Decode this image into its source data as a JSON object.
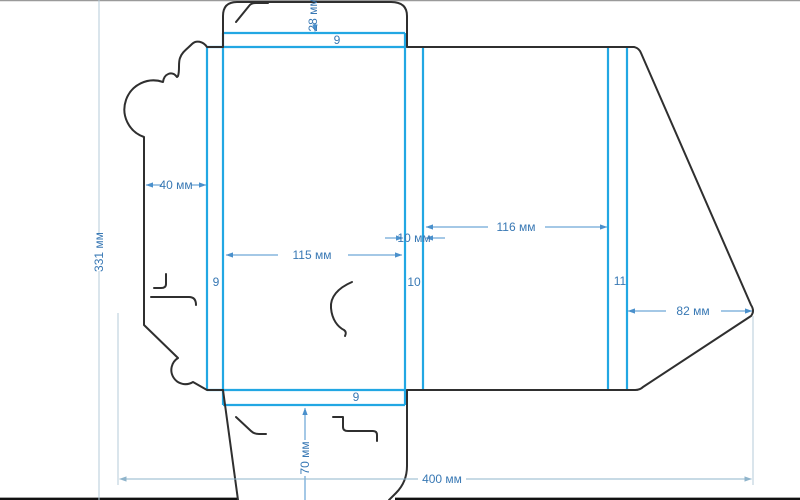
{
  "drawing": {
    "type": "packaging-dieline",
    "unit": "мм",
    "dimensions": {
      "total_width": "400 мм",
      "total_height": "331 мм",
      "top_flap": "28 мм",
      "glue_flap": "40 мм",
      "front_panel": "115 мм",
      "spine": "10 мм",
      "back_panel": "116 мм",
      "right_flap": "82 мм",
      "bottom_flap": "70 мм"
    },
    "strips": {
      "top": "9",
      "left": "9",
      "center": "10",
      "right": "11",
      "bottom": "9"
    },
    "colors": {
      "fold_line": "#22a7e3",
      "cut_line": "#2f2f2f",
      "dimension_line": "#4a90cc",
      "dimension_line_light": "#9dbdd3",
      "label_text": "#3878b4",
      "border": "#111111"
    }
  }
}
